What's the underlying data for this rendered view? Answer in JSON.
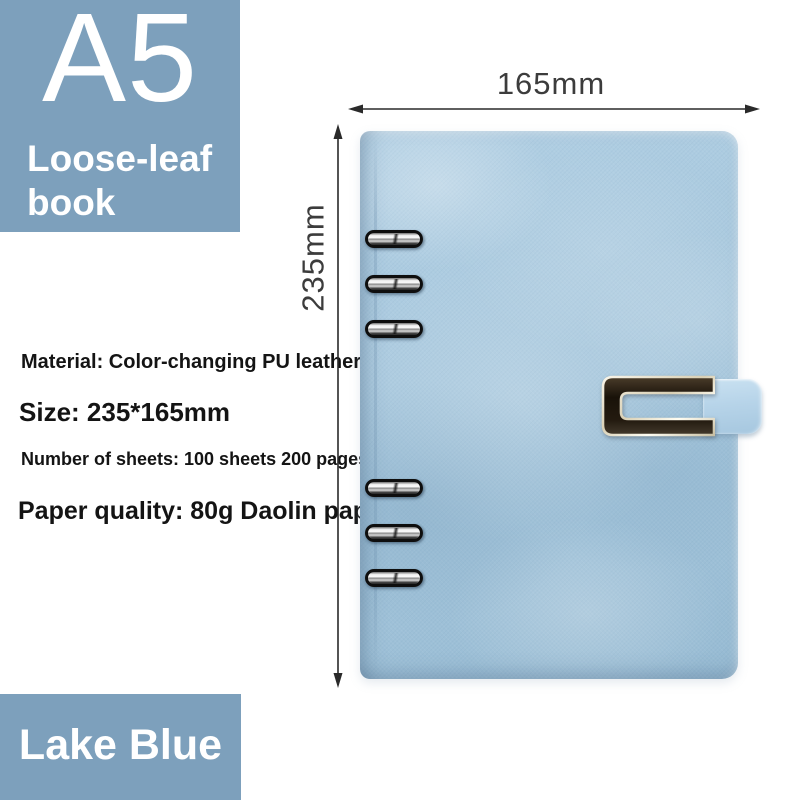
{
  "product_badge": {
    "size_label": "A5",
    "type_line1": "Loose-leaf",
    "type_line2": "book"
  },
  "specs": {
    "material": "Material: Color-changing PU leather",
    "size": "Size: 235*165mm",
    "sheets": "Number of sheets: 100 sheets 200 pages",
    "paper": "Paper quality: 80g Daolin paper"
  },
  "dimensions": {
    "width_label": "165mm",
    "height_label": "235mm"
  },
  "color_label": "Lake Blue",
  "notebook": {
    "ring_count": 6,
    "clasp": "metal-frame-magnetic-clasp"
  },
  "colors": {
    "badge_bg": "#7da0bc",
    "cover_base": "#a5c6dc",
    "cover_light": "#b2d0e4",
    "cover_dark": "#97bbd3",
    "strap": "#b7d4e9",
    "metal_light": "#f2edda",
    "metal_dark": "#1c150c",
    "dimension_ink": "#3c3c3c",
    "spec_ink": "#141414"
  }
}
